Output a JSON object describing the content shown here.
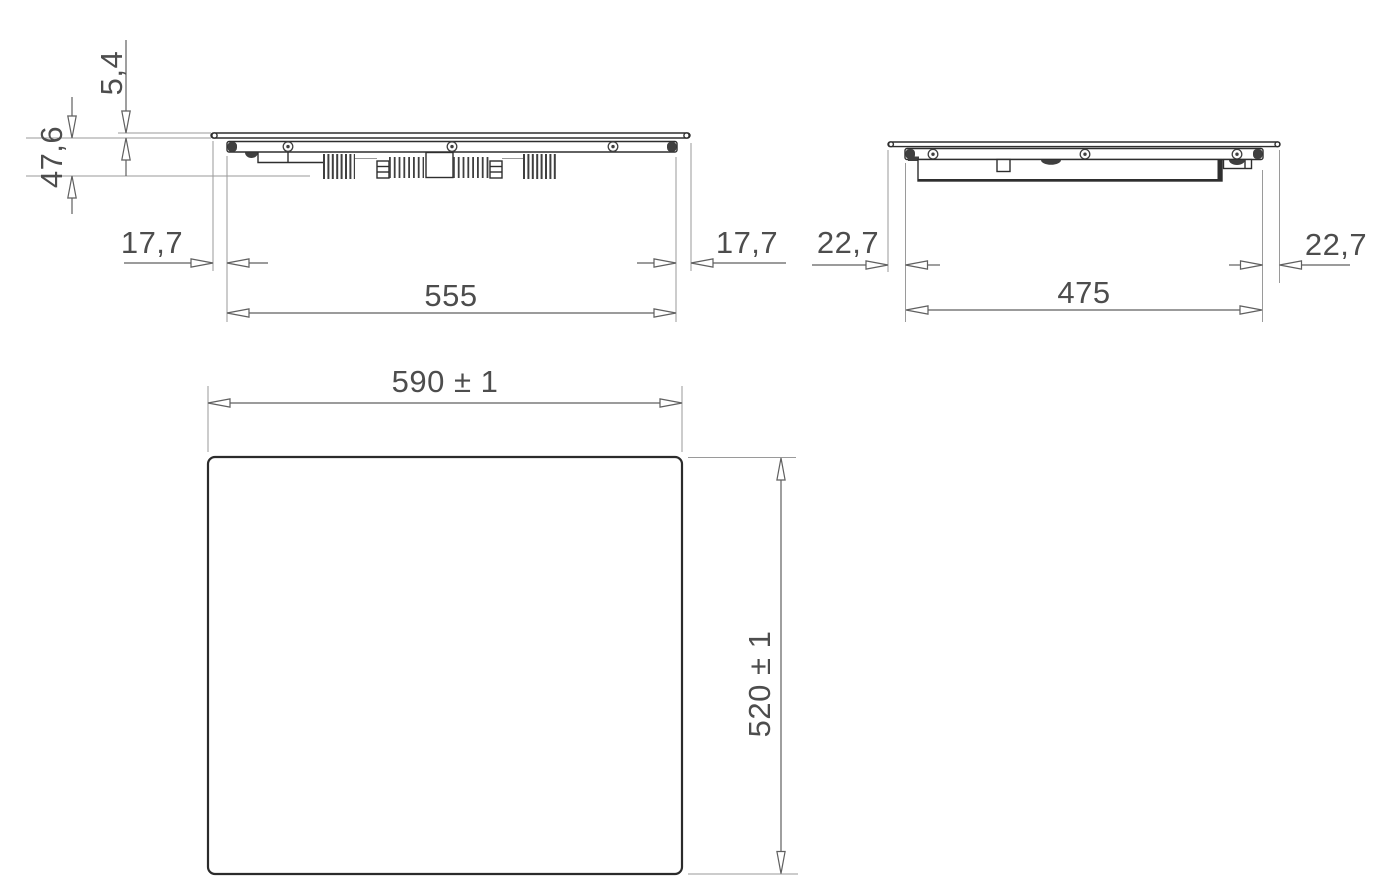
{
  "meta": {
    "drawing_type": "appliance installation dimension drawing",
    "views": [
      "front elevation",
      "side elevation",
      "top plan"
    ],
    "decimal_style": "comma"
  },
  "front_view": {
    "labels": {
      "glass_thickness": "5,4",
      "under_depth": "47,6",
      "offset_left": "17,7",
      "body_width": "555",
      "offset_right": "17,7"
    }
  },
  "side_view": {
    "labels": {
      "offset_left": "22,7",
      "body_depth": "475",
      "offset_right": "22,7"
    }
  },
  "top_view": {
    "labels": {
      "overall_width": "590 ± 1",
      "overall_depth": "520 ± 1"
    }
  },
  "colors": {
    "outline": "#2e2e2e",
    "dark_fill": "#3f3f3f",
    "dimension": "#5f5f5f",
    "extension": "#9a9a9a",
    "text": "#4d4d4d",
    "background": "#ffffff"
  }
}
